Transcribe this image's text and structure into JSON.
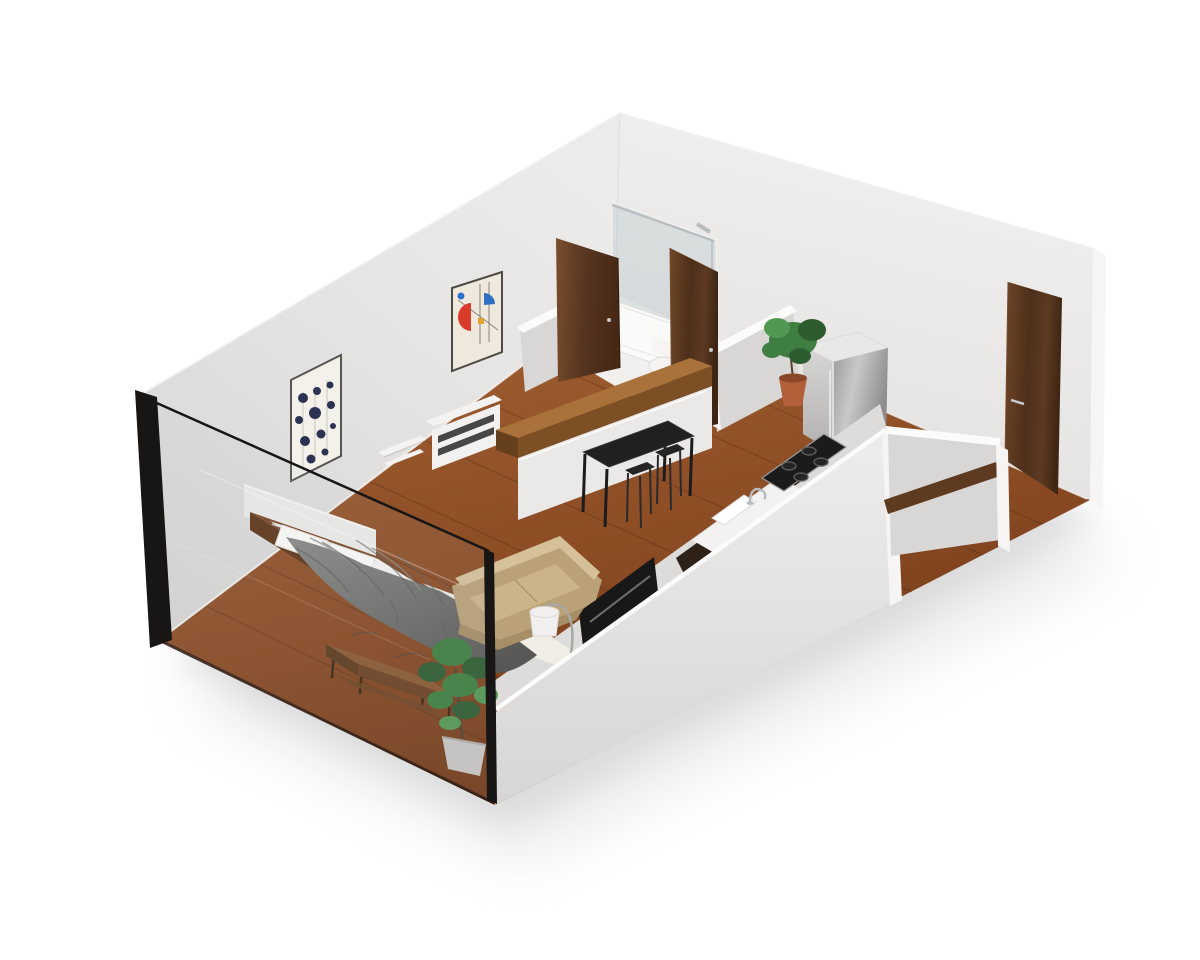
{
  "meta": {
    "title": "3D isometric cutaway floor plan — studio apartment",
    "view": "axonometric cutaway render, white background, front walls cut to glass"
  },
  "rooms": [
    {
      "name": "living-bedroom"
    },
    {
      "name": "bathroom"
    },
    {
      "name": "kitchen"
    },
    {
      "name": "entry"
    }
  ],
  "objects": [
    "platform-bed-with-gray-duvet",
    "two-white-pillows",
    "white-headboard-panel",
    "white-patterned-rug",
    "wood-coffee-table",
    "large-potted-plant",
    "tan-sofa",
    "arc-floor-lamp",
    "tv-panel-on-half-wall",
    "white-media-console",
    "white-wall-shelf",
    "framed-artwork-dots",
    "framed-artwork-abstract",
    "kitchen-island-wood-slab",
    "black-dining-table",
    "two-black-stools",
    "counter-with-sink-and-faucet",
    "induction-cooktop",
    "stainless-refrigerator",
    "small-terracotta-plant",
    "shower-glass-panel",
    "shower-tray",
    "toilet",
    "walnut-bathroom-doors",
    "walnut-entry-door",
    "glass-cut-front-wall"
  ],
  "colors": {
    "background": "#ffffff",
    "wall_rim": "#fbfbfa",
    "wall_edge_light": "#f6f5f4",
    "inner_wall": "#dedcda",
    "low_wall_shade": "#d9d7d5",
    "cut_edge_black": "#171615",
    "glass_tint": "rgba(175,190,200,0.10)",
    "glass_streak": "rgba(255,255,255,0.30)",
    "floor_edge": "#2a150a",
    "plank_line": "rgba(62,30,14,0.25)",
    "bath_floor": "#f1f0ee",
    "shower_tray": "#fafaf9",
    "glass_shower": "rgba(170,186,196,0.28)",
    "chrome": "#b9bcbe",
    "toilet": "#f6f5f3",
    "fridge_top": "#e9e8e6",
    "cooktop": "#1b1b1b",
    "burner": "#242424",
    "counter": "#f3f2f0",
    "sink": "#ffffff",
    "cabinet_dark": "#2e2118",
    "island_white": "#eae9e7",
    "slab_top": "#a8723a",
    "slab_side": "#7c4f25",
    "slab_end": "#66401d",
    "table_top": "#202020",
    "stool": "#2b2b2b",
    "console": "#f2f1ef",
    "console_slot": "#474747",
    "shelf": "#f4f3f1",
    "headboard": "#edebe8",
    "mattress": "#f5f3f0",
    "pillow": "#fcfbf9",
    "pillow_shade": "#e5e2dd",
    "bedframe": "#7b4828",
    "bedframe_dark": "#5e3517",
    "rug": "#efede5",
    "rug_pattern": "#44433f",
    "ctable_top": "#8a5930",
    "ctable_side": "#6b4121",
    "ctable_leg": "#3c2512",
    "sofa_top": "#d6c09a",
    "sofa_face": "#baa178",
    "sofa_seat": "#ccb489",
    "sofa_shadow": "#a68e66",
    "lamp_shade": "#f1f0ee",
    "lamp_metal": "#a8a7a5",
    "tv": "#181818",
    "tv_line": "#707070",
    "plant_green_dark": "#2d5c2f",
    "plant_green": "#3e7e40",
    "plant_green_light": "#539852",
    "trunk": "#58402a",
    "pot_gray": "#c8c6c2",
    "pot_gray_dark": "#a9a7a3",
    "pot_terracotta": "#b2603a",
    "pot_terracotta_dark": "#8c4628",
    "nook_wood": "#5e3b20",
    "handle_silver": "#c6c8ca"
  }
}
